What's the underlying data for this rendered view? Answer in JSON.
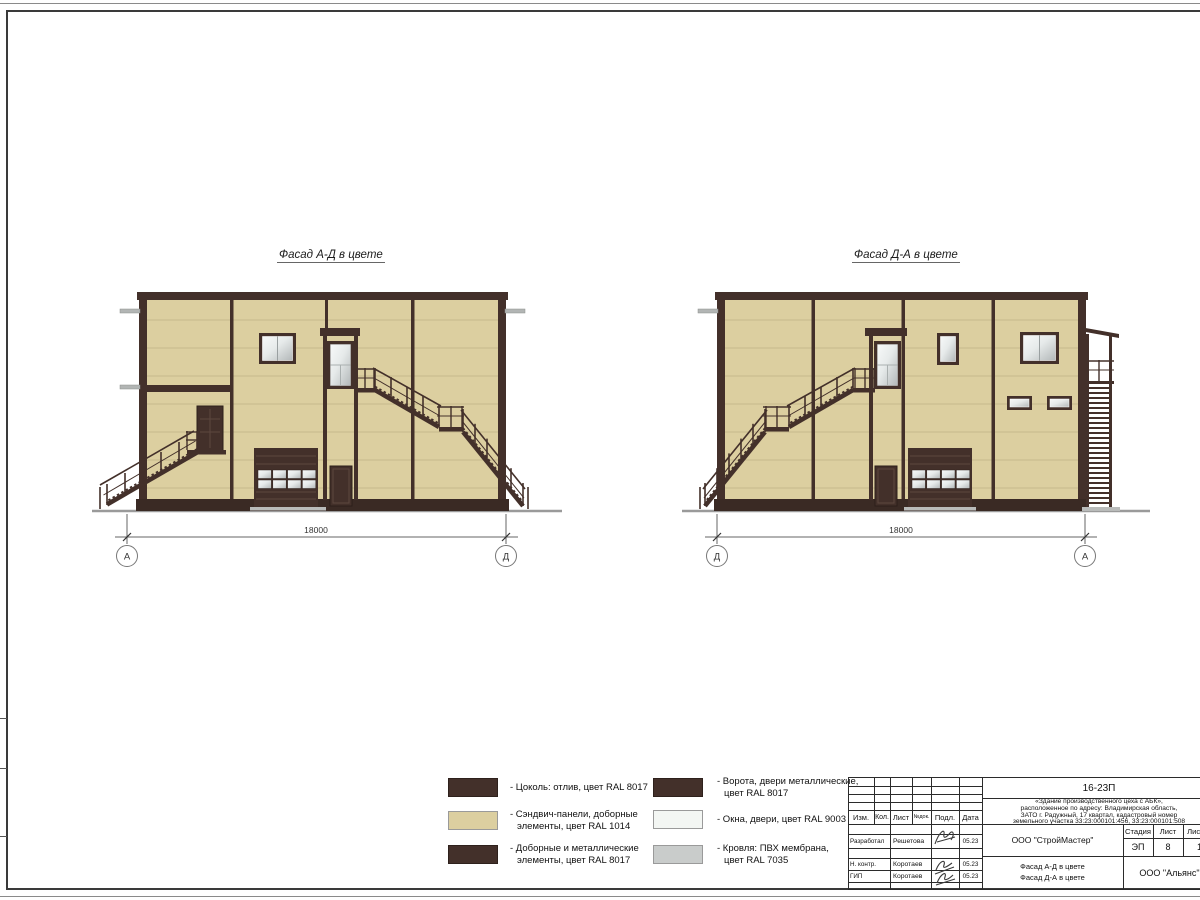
{
  "views": {
    "left": {
      "title": "Фасад А-Д в цвете",
      "dimension": "18000",
      "axis_left": "А",
      "axis_right": "Д"
    },
    "right": {
      "title": "Фасад Д-А в цвете",
      "dimension": "18000",
      "axis_left": "Д",
      "axis_right": "А"
    }
  },
  "legend": {
    "items": [
      {
        "label": "- Цоколь: отлив, цвет RAL 8017",
        "color": "#43302a"
      },
      {
        "label": "- Сэндвич-панели, доборные\nэлементы, цвет RAL 1014",
        "color": "#dccfa0"
      },
      {
        "label": "- Доборные и металлические\nэлементы, цвет RAL 8017",
        "color": "#43302a"
      },
      {
        "label": "- Ворота, двери металлические,\nцвет RAL 8017",
        "color": "#43302a"
      },
      {
        "label": "- Окна, двери, цвет RAL 9003",
        "color": "#f3f6f3"
      },
      {
        "label": "- Кровля: ПВХ мембрана,\nцвет RAL 7035",
        "color": "#c9cccb"
      }
    ]
  },
  "title_block": {
    "doc_number": "16-23П",
    "description": "«Здание производственного цеха с АБК»,\nрасположенное по адресу: Владимирская область,\nЗАТО г. Радужный, 17 квартал, кадастровый номер\nземельного участка 33:23:000101:456, 33:23:000101:508",
    "col_headers": {
      "izm": "Изм.",
      "kol": "Кол.",
      "list": "Лист",
      "ndok": "№док.",
      "podl": "Подл.",
      "data": "Дата"
    },
    "signers": [
      {
        "role": "Разработал",
        "name": "Решетова",
        "date": "05.23"
      },
      {
        "role": "Н. контр.",
        "name": "Коротаев",
        "date": "05.23"
      },
      {
        "role": "ГИП",
        "name": "Коротаев",
        "date": "05.23"
      }
    ],
    "org1": "ООО \"СтройМастер\"",
    "stage_header": "Стадия",
    "list_header": "Лист",
    "sheets_header": "Листов",
    "stage": "ЭП",
    "list_no": "8",
    "sheets": "1",
    "sheet_title": "Фасад А-Д в цвете\nФасад Д-А в цвете",
    "org2": "ООО \"Альянс\""
  },
  "colors": {
    "panel": "#dccfa0",
    "dark_brown": "#43302a",
    "roof_gray": "#c9cccb",
    "window_white": "#f3f6f3",
    "flashing_gray": "#b2b5b4"
  }
}
